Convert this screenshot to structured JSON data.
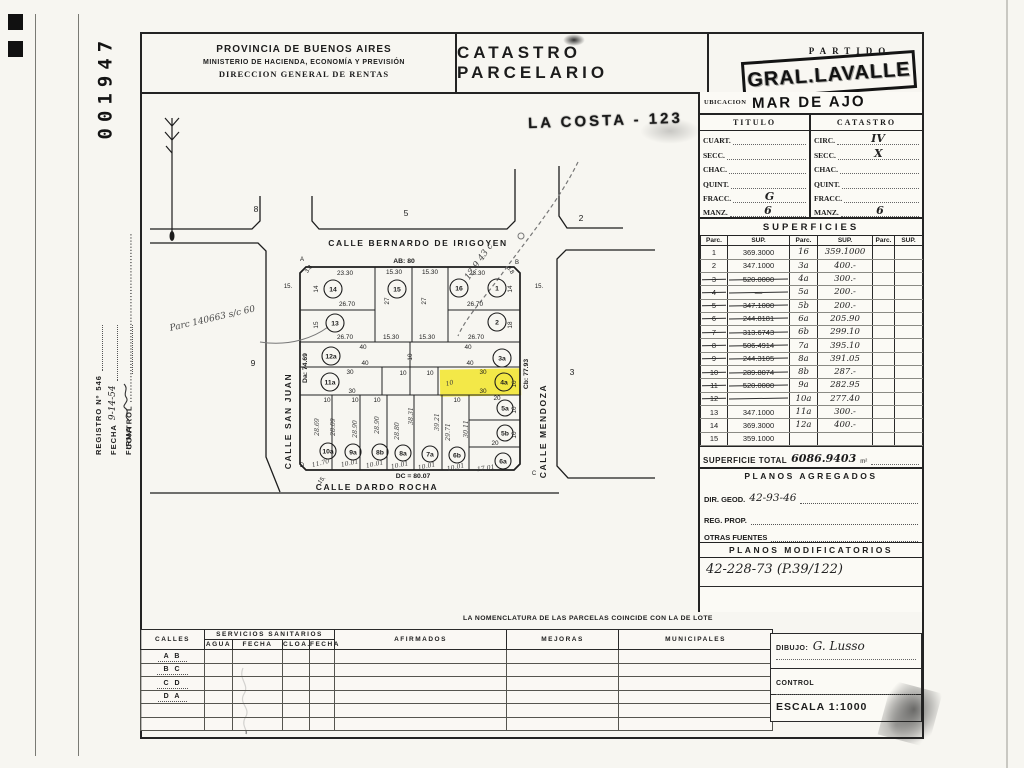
{
  "margin": {
    "stamp_number": "001947",
    "control_label": "CONTROL",
    "registro_label": "REGISTRO Nº",
    "registro_value": "546",
    "fecha_label": "FECHA",
    "fecha_value": "9-14-54",
    "firma_label": "FIRMA"
  },
  "header": {
    "org_line1": "PROVINCIA DE BUENOS AIRES",
    "org_line2": "MINISTERIO DE HACIENDA, ECONOMÍA Y PREVISIÓN",
    "org_line3": "DIRECCION GENERAL DE RENTAS",
    "title": "CATASTRO PARCELARIO",
    "partido_label": "PARTIDO",
    "partido_stamp": "GRAL.LAVALLE"
  },
  "location": {
    "ubicacion_label": "UBICACION",
    "ubicacion_value": "MAR DE AJO",
    "costa_stamp": "LA COSTA - 123"
  },
  "titulo_catastro": {
    "titulo_header": "TITULO",
    "catastro_header": "CATASTRO",
    "titulo_rows": [
      {
        "label": "CUART.",
        "value": ""
      },
      {
        "label": "SECC.",
        "value": ""
      },
      {
        "label": "CHAC.",
        "value": ""
      },
      {
        "label": "QUINT.",
        "value": ""
      },
      {
        "label": "FRACC.",
        "value": "G"
      },
      {
        "label": "MANZ.",
        "value": "6"
      }
    ],
    "catastro_rows": [
      {
        "label": "CIRC.",
        "value": "IV"
      },
      {
        "label": "SECC.",
        "value": "X"
      },
      {
        "label": "CHAC.",
        "value": ""
      },
      {
        "label": "QUINT.",
        "value": ""
      },
      {
        "label": "FRACC.",
        "value": ""
      },
      {
        "label": "MANZ.",
        "value": "6"
      }
    ]
  },
  "superficies": {
    "title": "SUPERFICIES",
    "col_parc": "Parc.",
    "col_sup": "SUP.",
    "rows": [
      {
        "parc1": "1",
        "sup1": "369.3000",
        "struck": false,
        "parc2": "16",
        "sup2": "359.1000"
      },
      {
        "parc1": "2",
        "sup1": "347.1000",
        "struck": false,
        "parc2": "3a",
        "sup2": "400.-"
      },
      {
        "parc1": "3",
        "sup1": "520.0000",
        "struck": true,
        "parc2": "4a",
        "sup2": "300.-"
      },
      {
        "parc1": "4",
        "sup1": "—",
        "struck": true,
        "parc2": "5a",
        "sup2": "200.-"
      },
      {
        "parc1": "5",
        "sup1": "347.1000",
        "struck": true,
        "parc2": "5b",
        "sup2": "200.-"
      },
      {
        "parc1": "6",
        "sup1": "244.8181",
        "struck": true,
        "parc2": "6a",
        "sup2": "205.90"
      },
      {
        "parc1": "7",
        "sup1": "313.6743",
        "struck": true,
        "parc2": "6b",
        "sup2": "299.10"
      },
      {
        "parc1": "8",
        "sup1": "506.4914",
        "struck": true,
        "parc2": "7a",
        "sup2": "395.10"
      },
      {
        "parc1": "9",
        "sup1": "244.3105",
        "struck": true,
        "parc2": "8a",
        "sup2": "391.05"
      },
      {
        "parc1": "10",
        "sup1": "289.8074",
        "struck": true,
        "parc2": "8b",
        "sup2": "287.-"
      },
      {
        "parc1": "11",
        "sup1": "520.0000",
        "struck": true,
        "parc2": "9a",
        "sup2": "282.95"
      },
      {
        "parc1": "12",
        "sup1": "",
        "struck": true,
        "parc2": "10a",
        "sup2": "277.40"
      },
      {
        "parc1": "13",
        "sup1": "347.1000",
        "struck": false,
        "parc2": "11a",
        "sup2": "300.-"
      },
      {
        "parc1": "14",
        "sup1": "369.3000",
        "struck": false,
        "parc2": "12a",
        "sup2": "400.-"
      },
      {
        "parc1": "15",
        "sup1": "359.1000",
        "struck": false,
        "parc2": "",
        "sup2": ""
      }
    ],
    "total_label": "SUPERFICIE TOTAL",
    "total_value": "6086.9403",
    "total_unit": "m²"
  },
  "planos_agregados": {
    "title": "PLANOS AGREGADOS",
    "dir_geod_label": "DIR. GEOD.",
    "dir_geod_value": "42-93-46",
    "reg_prop_label": "REG. PROP.",
    "otras_label": "OTRAS FUENTES"
  },
  "planos_modificatorios": {
    "title": "PLANOS MODIFICATORIOS",
    "entry": "42-228-73 (P.39/122)"
  },
  "bottom_table": {
    "note": "LA NOMENCLATURA DE LAS PARCELAS COINCIDE CON LA DE LOTE",
    "col_calles": "CALLES",
    "col_servicios": "SERVICIOS SANITARIOS",
    "sub_agua": "AGUA",
    "sub_fecha1": "FECHA",
    "sub_cloa": "CLOA.",
    "sub_fecha2": "FECHA",
    "col_afirmados": "AFIRMADOS",
    "col_mejoras": "MEJORAS",
    "col_municipales": "MUNICIPALES",
    "row_labels": [
      "A B",
      "B C",
      "C D",
      "D A",
      "",
      ""
    ]
  },
  "footer_boxes": {
    "dibujo_label": "DIBUJO:",
    "dibujo_value": "G. Lusso",
    "control_label": "CONTROL",
    "escala_label": "ESCALA 1:1000"
  },
  "map": {
    "highlight_color": "#f2e63a",
    "street_labels": [
      {
        "t": "CALLE BERNARDO DE IRIGOYEN",
        "x": 418,
        "y": 246,
        "r": 0
      },
      {
        "t": "CALLE SAN JUAN",
        "x": 291,
        "y": 421,
        "r": -90
      },
      {
        "t": "CALLE MENDOZA",
        "x": 546,
        "y": 431,
        "r": -90
      },
      {
        "t": "CALLE DARDO ROCHA",
        "x": 377,
        "y": 490,
        "r": 0
      }
    ],
    "block_labels": [
      {
        "t": "8",
        "x": 256,
        "y": 212
      },
      {
        "t": "5",
        "x": 406,
        "y": 216
      },
      {
        "t": "2",
        "x": 581,
        "y": 221
      },
      {
        "t": "9",
        "x": 253,
        "y": 366
      },
      {
        "t": "3",
        "x": 572,
        "y": 375
      }
    ],
    "edge_labels": [
      {
        "t": "AB: 80",
        "x": 404,
        "y": 263
      },
      {
        "t": "Da: 74.69",
        "x": 307,
        "y": 368,
        "r": -90
      },
      {
        "t": "Cb: 77.93",
        "x": 528,
        "y": 374,
        "r": -90
      },
      {
        "t": "DC = 80.07",
        "x": 413,
        "y": 478
      }
    ],
    "corner_labels": [
      {
        "t": "A",
        "x": 302,
        "y": 261
      },
      {
        "t": "B",
        "x": 517,
        "y": 264
      },
      {
        "t": "C",
        "x": 534,
        "y": 475
      },
      {
        "t": "D",
        "x": 302,
        "y": 467
      },
      {
        "t": "3.8",
        "x": 310,
        "y": 270,
        "r": -55,
        "s": 5
      },
      {
        "t": "3.8",
        "x": 509,
        "y": 271,
        "r": 55,
        "s": 5
      },
      {
        "t": "15.",
        "x": 288,
        "y": 288
      },
      {
        "t": "15.",
        "x": 539,
        "y": 288
      },
      {
        "t": "15.",
        "x": 323,
        "y": 481,
        "r": -50
      }
    ],
    "dim_labels": [
      {
        "t": "23.30",
        "x": 345,
        "y": 275
      },
      {
        "t": "15.30",
        "x": 394,
        "y": 274
      },
      {
        "t": "15.30",
        "x": 430,
        "y": 274
      },
      {
        "t": "23.30",
        "x": 477,
        "y": 275
      },
      {
        "t": "26.70",
        "x": 347,
        "y": 306
      },
      {
        "t": "26.70",
        "x": 475,
        "y": 306
      },
      {
        "t": "26.70",
        "x": 345,
        "y": 339
      },
      {
        "t": "15.30",
        "x": 391,
        "y": 339
      },
      {
        "t": "15.30",
        "x": 427,
        "y": 339
      },
      {
        "t": "26.70",
        "x": 476,
        "y": 339
      },
      {
        "t": "40",
        "x": 363,
        "y": 349
      },
      {
        "t": "40",
        "x": 468,
        "y": 349
      },
      {
        "t": "40",
        "x": 365,
        "y": 365
      },
      {
        "t": "40",
        "x": 470,
        "y": 365
      },
      {
        "t": "30",
        "x": 350,
        "y": 374
      },
      {
        "t": "10",
        "x": 403,
        "y": 375
      },
      {
        "t": "10",
        "x": 430,
        "y": 375
      },
      {
        "t": "30",
        "x": 483,
        "y": 374
      },
      {
        "t": "30",
        "x": 352,
        "y": 393
      },
      {
        "t": "30",
        "x": 483,
        "y": 393
      },
      {
        "t": "10",
        "x": 327,
        "y": 402
      },
      {
        "t": "10",
        "x": 355,
        "y": 402
      },
      {
        "t": "10",
        "x": 377,
        "y": 402
      },
      {
        "t": "10",
        "x": 457,
        "y": 402
      },
      {
        "t": "20",
        "x": 497,
        "y": 400
      },
      {
        "t": "20",
        "x": 495,
        "y": 445
      },
      {
        "t": "14",
        "x": 318,
        "y": 289,
        "r": -90
      },
      {
        "t": "27",
        "x": 389,
        "y": 301,
        "r": -90
      },
      {
        "t": "27",
        "x": 426,
        "y": 301,
        "r": -90
      },
      {
        "t": "14",
        "x": 512,
        "y": 289,
        "r": -90
      },
      {
        "t": "15",
        "x": 318,
        "y": 325,
        "r": -90
      },
      {
        "t": "18",
        "x": 512,
        "y": 325,
        "r": -90
      },
      {
        "t": "10",
        "x": 412,
        "y": 357,
        "r": -90
      },
      {
        "t": "10",
        "x": 516,
        "y": 384,
        "r": -90
      },
      {
        "t": "10",
        "x": 516,
        "y": 410,
        "r": -90
      },
      {
        "t": "10",
        "x": 516,
        "y": 435,
        "r": -90
      }
    ],
    "pencil_labels": [
      {
        "t": "28.69",
        "x": 319,
        "y": 427,
        "r": -90
      },
      {
        "t": "28.09",
        "x": 335,
        "y": 427,
        "r": -90
      },
      {
        "t": "28.90",
        "x": 357,
        "y": 429,
        "r": -90
      },
      {
        "t": "28.90",
        "x": 379,
        "y": 425,
        "r": -90
      },
      {
        "t": "28.80",
        "x": 399,
        "y": 431,
        "r": -90
      },
      {
        "t": "38.31",
        "x": 413,
        "y": 416,
        "r": -90
      },
      {
        "t": "39.21",
        "x": 439,
        "y": 422,
        "r": -90
      },
      {
        "t": "29.71",
        "x": 450,
        "y": 432,
        "r": -90
      },
      {
        "t": "30.11",
        "x": 468,
        "y": 429,
        "r": -90
      },
      {
        "t": "11.70",
        "x": 321,
        "y": 465,
        "r": -14
      },
      {
        "t": "10.01",
        "x": 350,
        "y": 465,
        "r": -12
      },
      {
        "t": "10.01",
        "x": 375,
        "y": 466,
        "r": -12
      },
      {
        "t": "10.01",
        "x": 400,
        "y": 467,
        "r": -12
      },
      {
        "t": "10.01",
        "x": 427,
        "y": 468,
        "r": -12
      },
      {
        "t": "10.01",
        "x": 456,
        "y": 469,
        "r": -12
      },
      {
        "t": "17.01",
        "x": 486,
        "y": 470,
        "r": -8
      },
      {
        "t": "10",
        "x": 450,
        "y": 385,
        "r": -15
      }
    ],
    "annotations": [
      {
        "t": "Parc 140663 s/c 60",
        "x": 213,
        "y": 321,
        "r": -13,
        "s": 10
      },
      {
        "t": "12.9 43 c",
        "x": 481,
        "y": 263,
        "r": -55,
        "s": 8
      }
    ],
    "parcels": [
      {
        "id": "14",
        "x": 333,
        "y": 289,
        "r": 9
      },
      {
        "id": "15",
        "x": 397,
        "y": 289,
        "r": 9
      },
      {
        "id": "16",
        "x": 459,
        "y": 288,
        "r": 9
      },
      {
        "id": "1",
        "x": 497,
        "y": 288,
        "r": 9
      },
      {
        "id": "13",
        "x": 335,
        "y": 323,
        "r": 9
      },
      {
        "id": "2",
        "x": 497,
        "y": 322,
        "r": 9
      },
      {
        "id": "12a",
        "x": 331,
        "y": 356,
        "r": 9
      },
      {
        "id": "3a",
        "x": 502,
        "y": 358,
        "r": 9
      },
      {
        "id": "11a",
        "x": 330,
        "y": 382,
        "r": 9
      },
      {
        "id": "4a",
        "x": 504,
        "y": 382,
        "r": 9,
        "hl": true
      },
      {
        "id": "5a",
        "x": 505,
        "y": 408,
        "r": 8
      },
      {
        "id": "5b",
        "x": 505,
        "y": 433,
        "r": 8
      },
      {
        "id": "10a",
        "x": 328,
        "y": 451,
        "r": 8
      },
      {
        "id": "9a",
        "x": 353,
        "y": 452,
        "r": 8
      },
      {
        "id": "8b",
        "x": 380,
        "y": 452,
        "r": 8
      },
      {
        "id": "8a",
        "x": 403,
        "y": 453,
        "r": 8
      },
      {
        "id": "7a",
        "x": 430,
        "y": 454,
        "r": 8
      },
      {
        "id": "6b",
        "x": 457,
        "y": 455,
        "r": 8
      },
      {
        "id": "6a",
        "x": 503,
        "y": 461,
        "r": 8
      }
    ]
  }
}
